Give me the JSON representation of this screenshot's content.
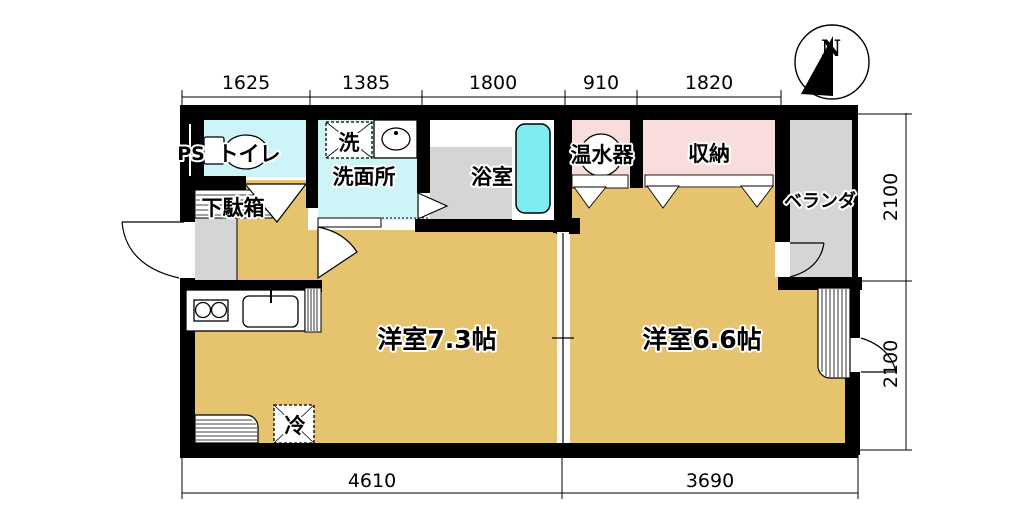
{
  "title": "apartment-floor-plan",
  "compass": {
    "north_label": "N"
  },
  "labels": {
    "ps": "PS",
    "toilet": "トイレ",
    "washer": "洗",
    "washroom": "洗面所",
    "bathroom": "浴室",
    "water_heater": "温水器",
    "storage": "収納",
    "veranda": "ベランダ",
    "shoe_cabinet": "下駄箱",
    "fridge": "冷",
    "western_room_a": "洋室7.3帖",
    "western_room_b": "洋室6.6帖"
  },
  "dimensions": {
    "top": [
      "1625",
      "1385",
      "1800",
      "910",
      "1820"
    ],
    "right": [
      "2100",
      "2100"
    ],
    "bottom": [
      "4610",
      "3690"
    ]
  },
  "colors": {
    "floor_tan": "#E5C36F",
    "wet_room_cyan": "#CDF4F6",
    "bathtub_cyan": "#7EEDF2",
    "closet_pink": "#F9DCDC",
    "concrete_gray": "#D5D5D5",
    "wall_black": "#000000"
  }
}
